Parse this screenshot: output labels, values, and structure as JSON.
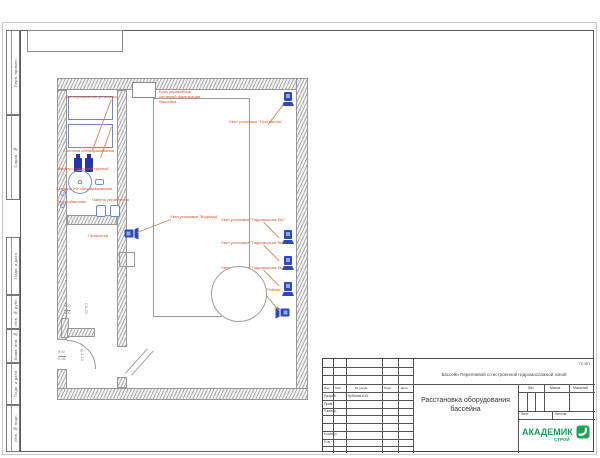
{
  "sheet": {
    "margin_boxes": [
      {
        "label": "Перв. примен."
      },
      {
        "label": "Справ. №"
      },
      {
        "label": "Подп. и дата"
      },
      {
        "label": "Инв. № дубл."
      },
      {
        "label": "Взам. инв. №"
      },
      {
        "label": "Подп. и дата"
      },
      {
        "label": "Инв. № подл."
      }
    ],
    "title_block": {
      "code": "ТХ.ВП",
      "project": "Бассейн Переляевой со встроенной гидромассажной зоной",
      "sheet_title": "Расстановка оборудования\nбассейна",
      "columns": {
        "izm": "Изм.",
        "list": "Лист",
        "ndok": "№ докум.",
        "podp": "Подп.",
        "data": "Дата"
      },
      "rows": [
        {
          "role": "Разраб.",
          "name": "Куботов А.В."
        },
        {
          "role": "Пров.",
          "name": ""
        },
        {
          "role": "Т.контр.",
          "name": ""
        },
        {
          "role": "Н.контр.",
          "name": ""
        },
        {
          "role": "Утв.",
          "name": ""
        }
      ],
      "lit": "Лит.",
      "massa": "Масса",
      "masshtab": "Масштаб",
      "list_label": "Лист",
      "listov_label": "Листов",
      "logo": {
        "line1": "АКАДЕМИК",
        "line2": "СТРОЙ"
      }
    }
  },
  "plan": {
    "labels": [
      {
        "text": "Фильтровальная установка"
      },
      {
        "text": "Система обеззараживания"
      },
      {
        "text": "Фильтр с насосной группой"
      },
      {
        "text": "Станция УФ обеззараживания"
      },
      {
        "text": "Теплообменник"
      },
      {
        "text": "Панель управления"
      },
      {
        "text": "Блок управления\nсистемой фильтрации\nбассейна"
      },
      {
        "text": "Узел установки \"Противоток\""
      },
      {
        "text": "Узел установки \"Водопад\""
      },
      {
        "text": "Узел установки \"Гидромассаж №1\""
      },
      {
        "text": "Узел установки \"Гидромассаж №2\""
      },
      {
        "text": "Узел установки \"Гидромассаж №3\""
      },
      {
        "text": "Форсунка пылесоса \"Гейзер\""
      },
      {
        "text": "Прожектор"
      }
    ],
    "dims": [
      {
        "text": "400"
      },
      {
        "text": "400"
      },
      {
        "text": "СК-03"
      },
      {
        "text": "900"
      },
      {
        "text": "2,06"
      },
      {
        "text": "Д-1,15"
      }
    ]
  }
}
